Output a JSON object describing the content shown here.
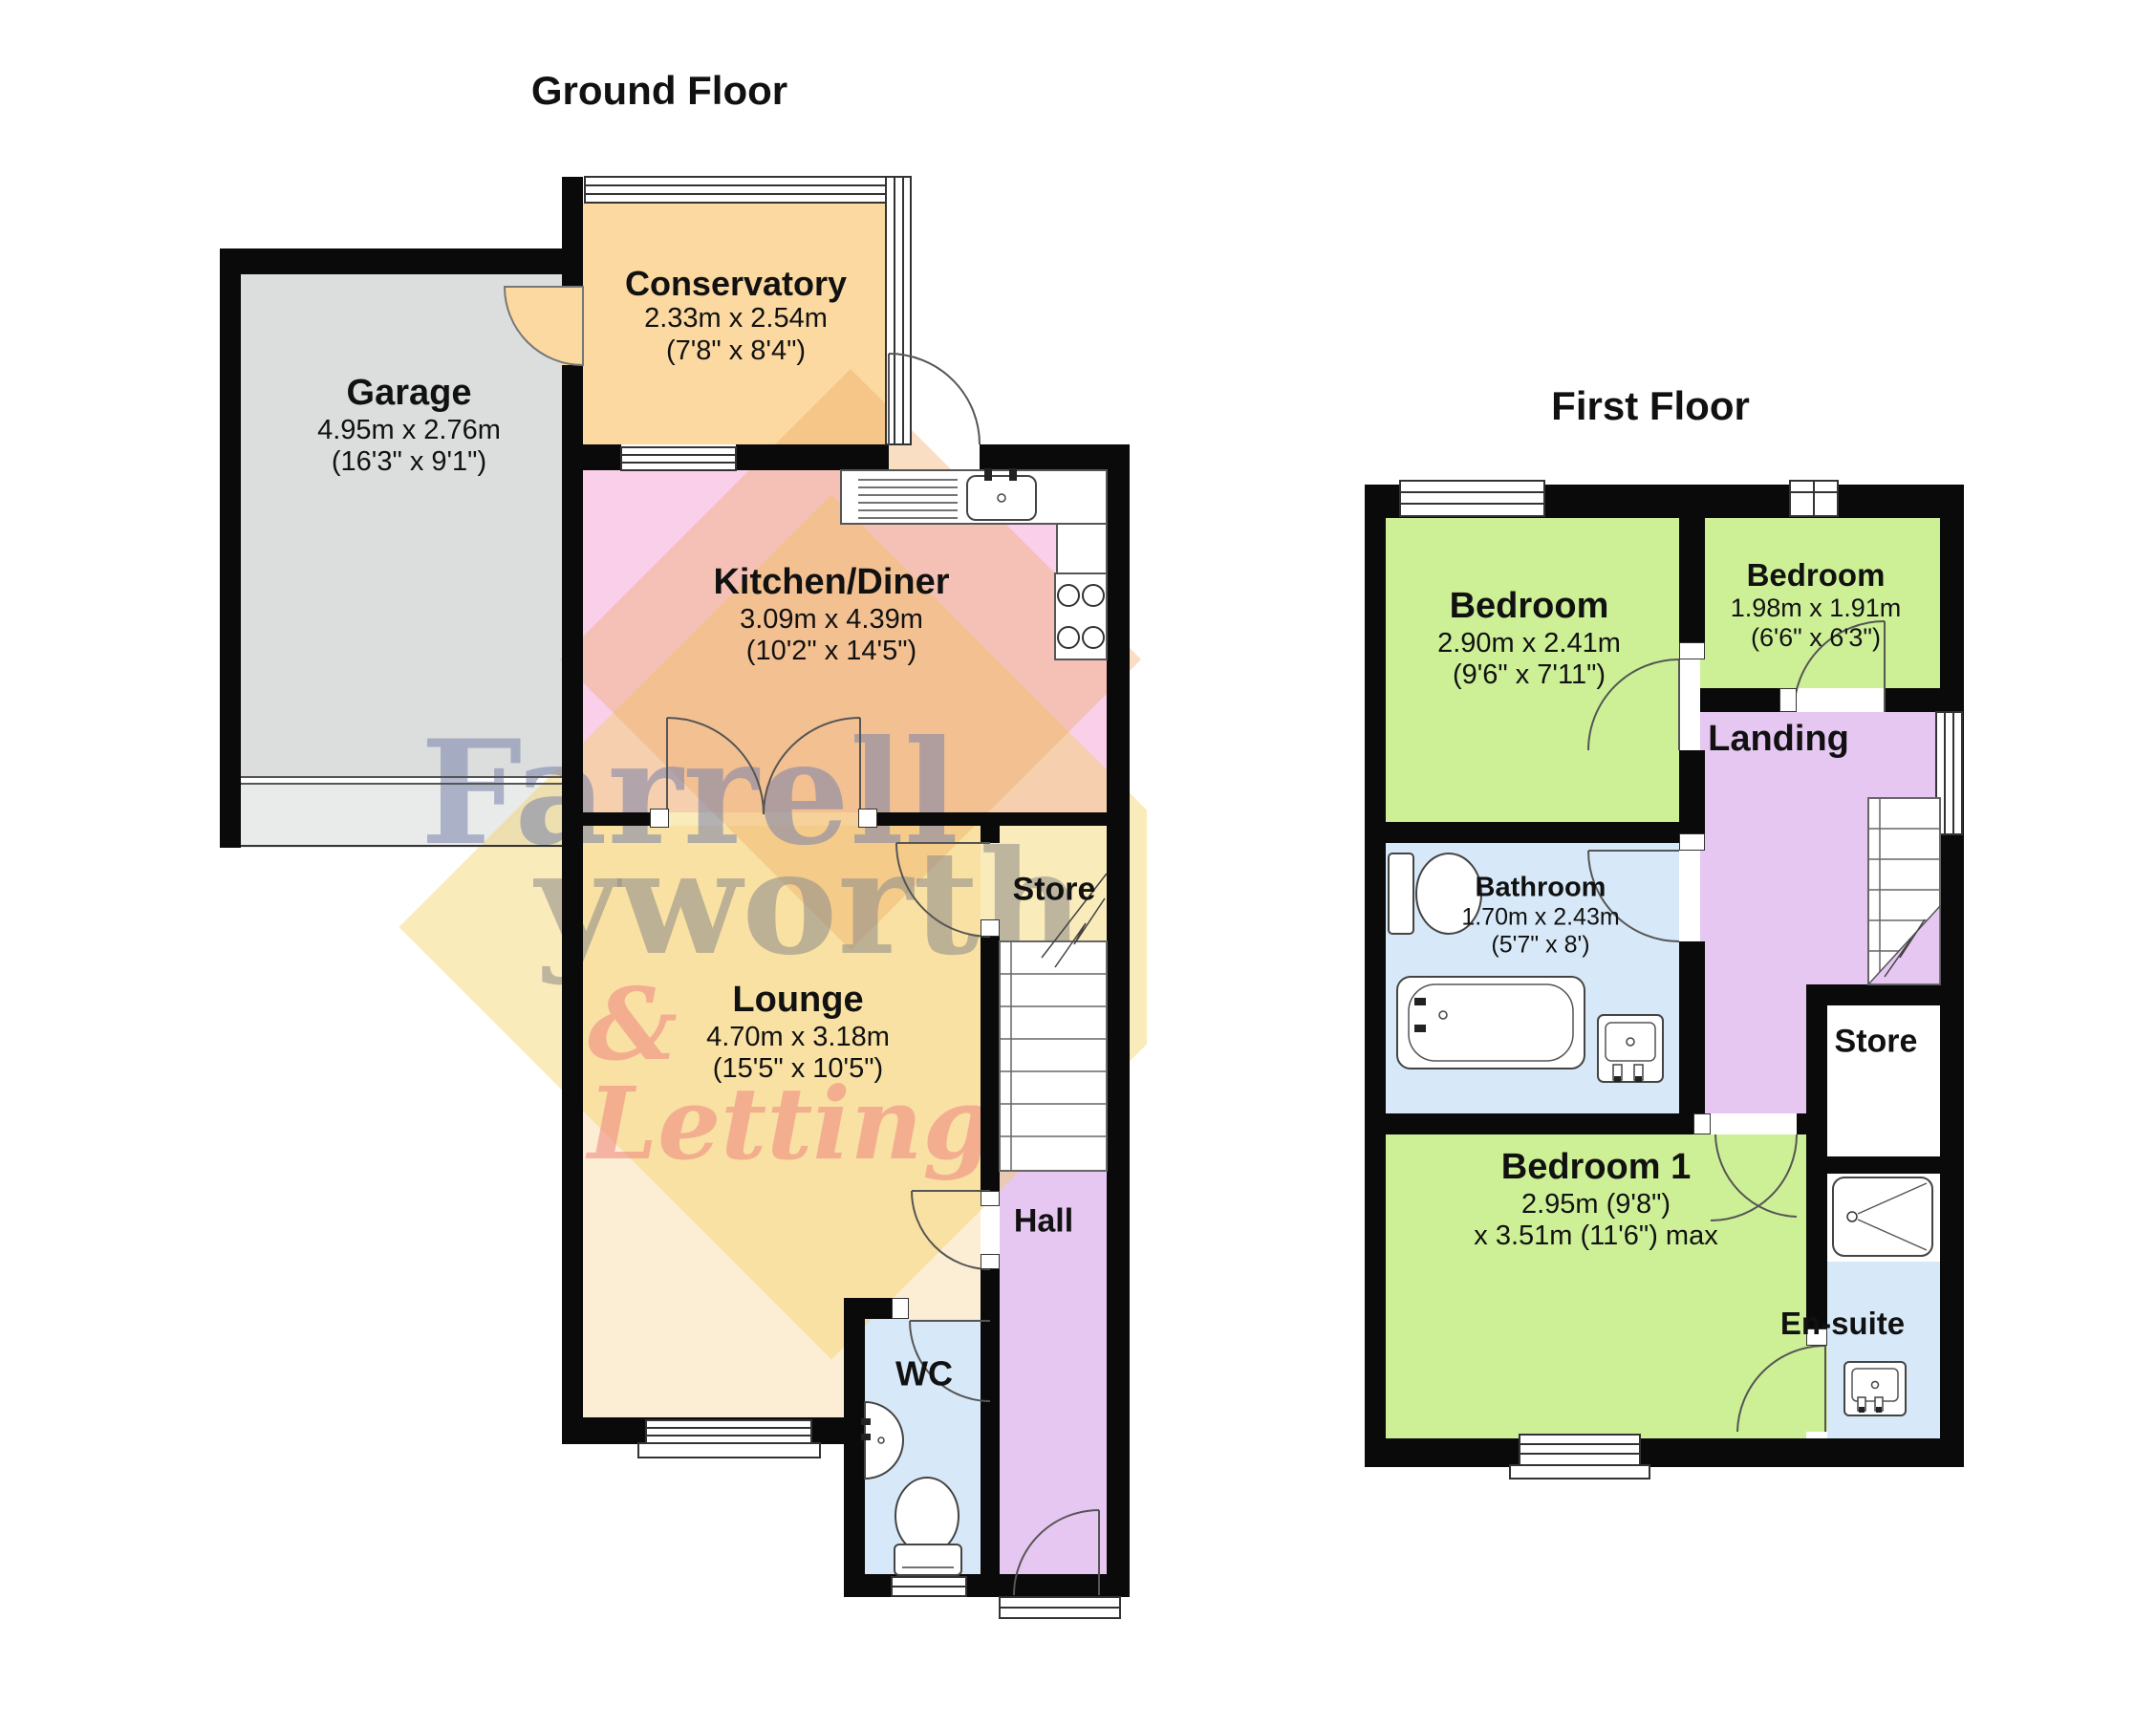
{
  "document": {
    "type": "floorplan"
  },
  "ground_floor": {
    "title": "Ground Floor",
    "rooms": {
      "garage": {
        "name": "Garage",
        "dims_m": "4.95m x 2.76m",
        "dims_ft": "(16'3\" x 9'1\")"
      },
      "conservatory": {
        "name": "Conservatory",
        "dims_m": "2.33m x 2.54m",
        "dims_ft": "(7'8\" x 8'4\")"
      },
      "kitchen": {
        "name": "Kitchen/Diner",
        "dims_m": "3.09m x 4.39m",
        "dims_ft": "(10'2\" x 14'5\")"
      },
      "lounge": {
        "name": "Lounge",
        "dims_m": "4.70m x 3.18m",
        "dims_ft": "(15'5\" x 10'5\")"
      },
      "store": {
        "name": "Store"
      },
      "hall": {
        "name": "Hall"
      },
      "wc": {
        "name": "WC"
      }
    }
  },
  "first_floor": {
    "title": "First Floor",
    "rooms": {
      "bedroom_left": {
        "name": "Bedroom",
        "dims_m": "2.90m x 2.41m",
        "dims_ft": "(9'6\" x 7'11\")"
      },
      "bedroom_right": {
        "name": "Bedroom",
        "dims_m": "1.98m x 1.91m",
        "dims_ft": "(6'6\" x 6'3\")"
      },
      "landing": {
        "name": "Landing"
      },
      "bathroom": {
        "name": "Bathroom",
        "dims_m": "1.70m x 2.43m",
        "dims_ft": "(5'7\" x 8')"
      },
      "bedroom_1": {
        "name": "Bedroom 1",
        "dims_line1": "2.95m (9'8\")",
        "dims_line2": "x 3.51m (11'6\") max"
      },
      "store": {
        "name": "Store"
      },
      "ensuite": {
        "name": "En-suite"
      }
    }
  },
  "watermark": {
    "line1": "Farrell",
    "line2": "yworth",
    "line3": "& Lettings"
  },
  "colors": {
    "wall": "#0a0a0a",
    "garage": "#dcdddd",
    "conservatory": "#fbd9a1",
    "kitchen": "#f9cfe9",
    "lounge": "#fbeed4",
    "hall_landing": "#e6c7f2",
    "bathroom_wc": "#d7e9f8",
    "bedroom": "#cdf097",
    "watermark_blue": "#7a86aa",
    "watermark_gray": "#94918a",
    "watermark_salmon": "#f08c82",
    "watermark_yellow": "#f2cf5c"
  }
}
